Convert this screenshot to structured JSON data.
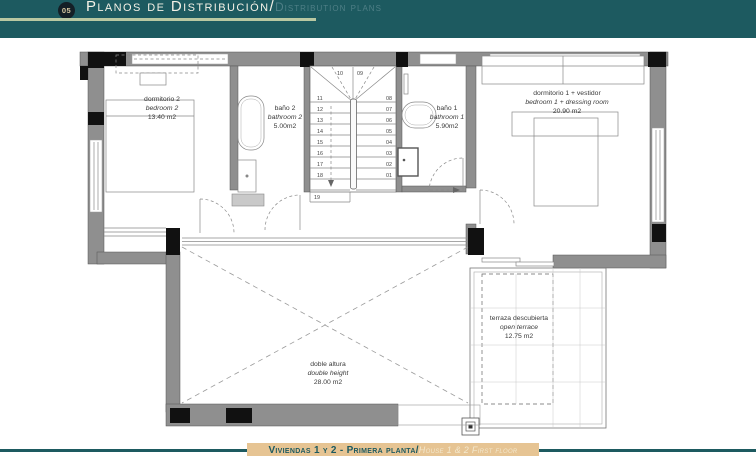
{
  "header": {
    "number": "05",
    "title_es": "Planos de Distribución/",
    "title_en": "Distribution plans"
  },
  "footer": {
    "title_es": "Viviendas 1 y 2 - Primera planta/",
    "title_en": "House 1 & 2 First floor"
  },
  "plan": {
    "rooms": {
      "bedroom2": {
        "name_es": "dormitorio 2",
        "name_en": "bedroom 2",
        "area": "13.40 m2"
      },
      "bathroom2": {
        "name_es": "baño 2",
        "name_en": "bathroom 2",
        "area": "5.00m2"
      },
      "bathroom1": {
        "name_es": "baño 1",
        "name_en": "bathroom 1",
        "area": "5.90m2"
      },
      "bedroom1": {
        "name_es": "dormitorio 1 + vestidor",
        "name_en": "bedroom 1 + dressing room",
        "area": "20.90 m2"
      },
      "terrace": {
        "name_es": "terraza descubierta",
        "name_en": "open terrace",
        "area": "12.75 m2"
      },
      "double_height": {
        "name_es": "doble altura",
        "name_en": "double height",
        "area": "28.00 m2"
      }
    },
    "stairs": {
      "top": [
        "10",
        "09"
      ],
      "left": [
        "11",
        "12",
        "13",
        "14",
        "15",
        "16",
        "17",
        "18",
        "19"
      ],
      "right": [
        "08",
        "07",
        "06",
        "05",
        "04",
        "03",
        "02",
        "01"
      ]
    }
  },
  "colors": {
    "header_teal": "#1d5a60",
    "sage_line": "#b9c8a2",
    "footer_tan": "#e6c493",
    "wall_gray": "#8f8f8f",
    "column_black": "#111111"
  }
}
